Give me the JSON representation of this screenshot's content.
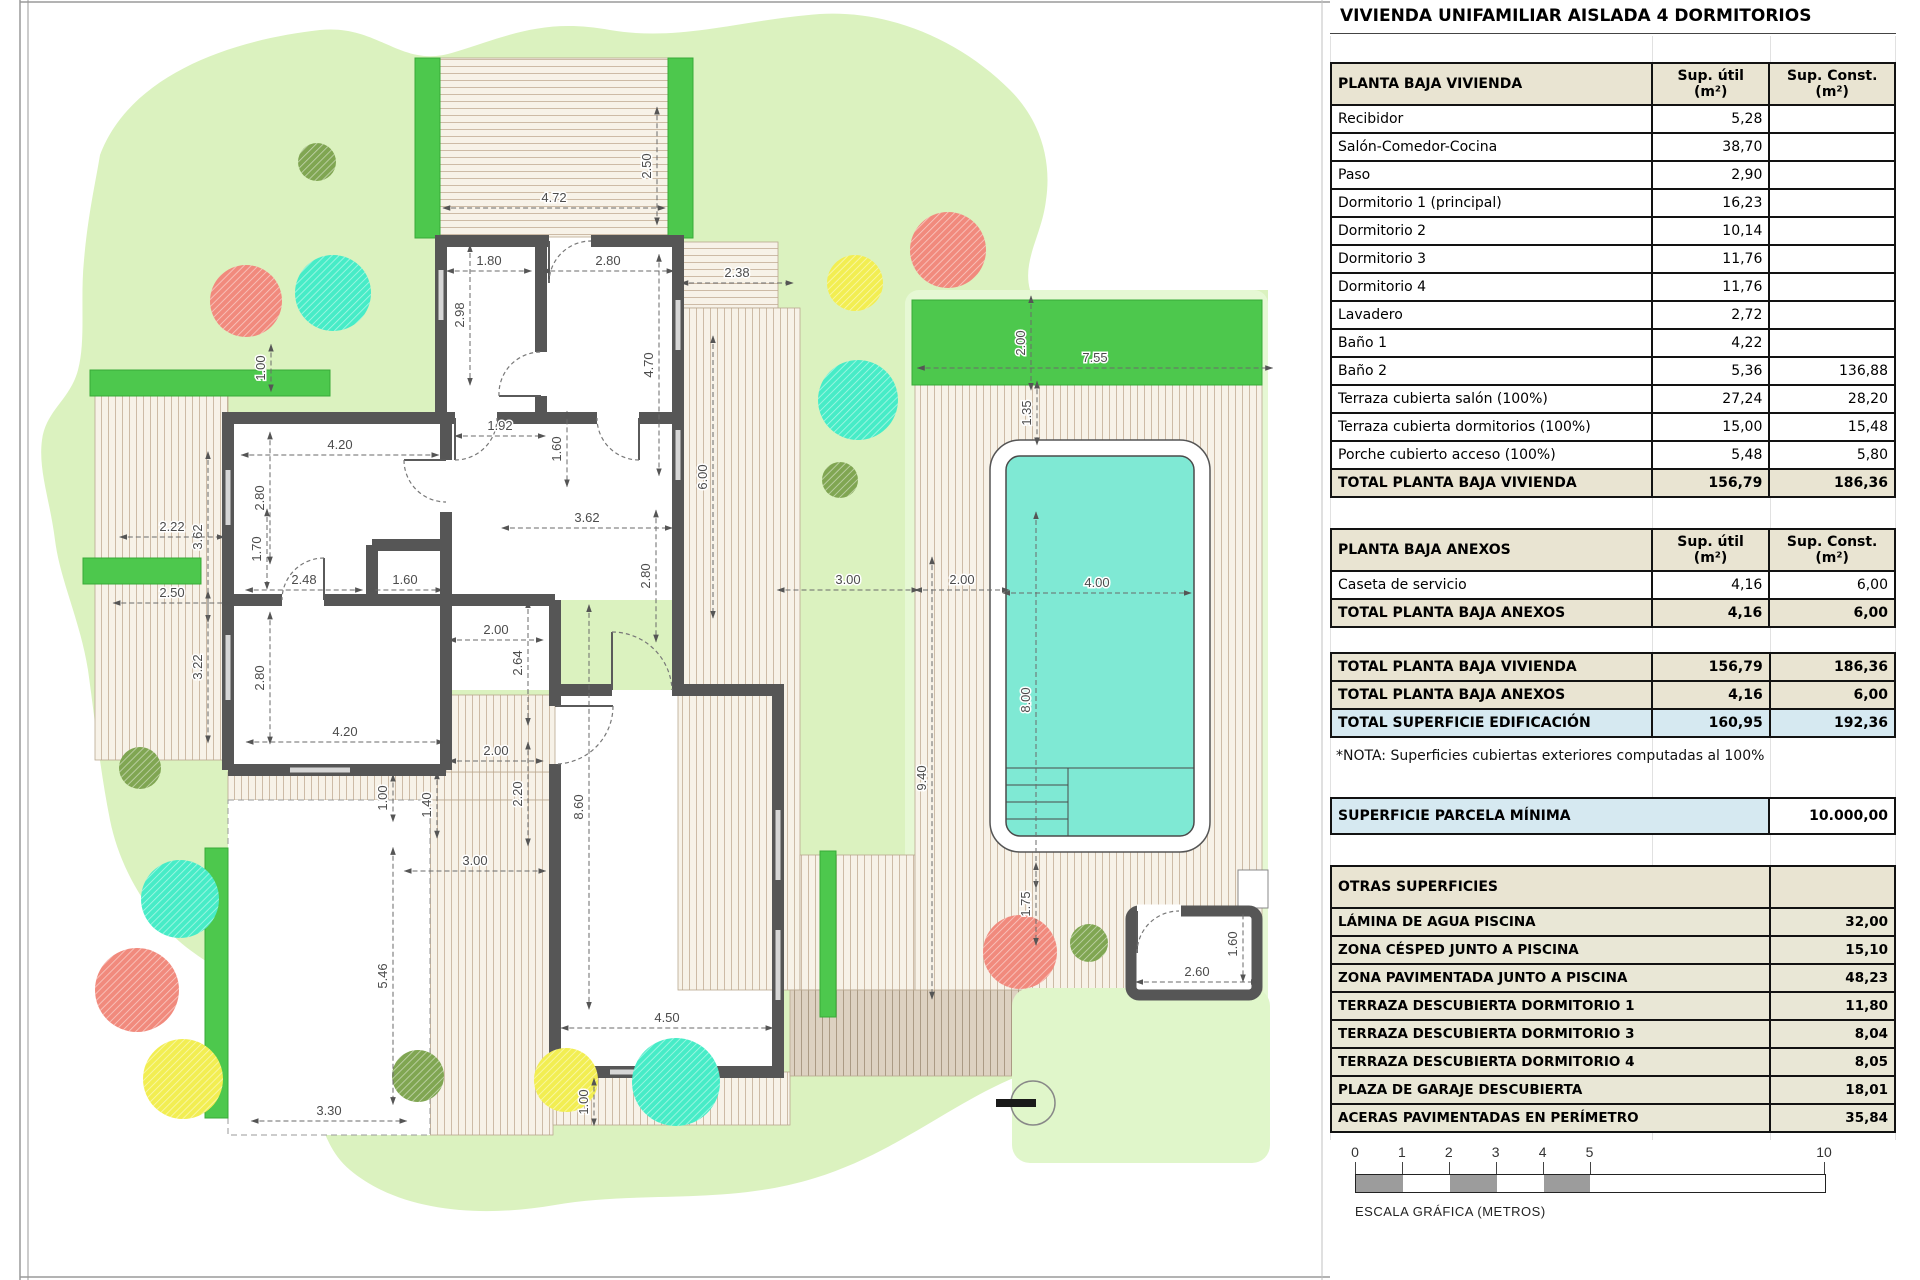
{
  "title": "VIVIENDA UNIFAMILIAR AISLADA 4 DORMITORIOS",
  "tables": {
    "vivienda": {
      "title": "PLANTA BAJA VIVIENDA",
      "col_util_l1": "Sup. útil",
      "col_const_l1": "Sup. Const.",
      "unit": "(m²)",
      "rows": [
        {
          "name": "Recibidor",
          "util": "5,28",
          "cons": ""
        },
        {
          "name": "Salón-Comedor-Cocina",
          "util": "38,70",
          "cons": ""
        },
        {
          "name": "Paso",
          "util": "2,90",
          "cons": ""
        },
        {
          "name": "Dormitorio 1 (principal)",
          "util": "16,23",
          "cons": ""
        },
        {
          "name": "Dormitorio 2",
          "util": "10,14",
          "cons": ""
        },
        {
          "name": "Dormitorio 3",
          "util": "11,76",
          "cons": ""
        },
        {
          "name": "Dormitorio 4",
          "util": "11,76",
          "cons": ""
        },
        {
          "name": "Lavadero",
          "util": "2,72",
          "cons": ""
        },
        {
          "name": "Baño 1",
          "util": "4,22",
          "cons": ""
        },
        {
          "name": "Baño 2",
          "util": "5,36",
          "cons": "136,88"
        },
        {
          "name": "Terraza cubierta salón (100%)",
          "util": "27,24",
          "cons": "28,20"
        },
        {
          "name": "Terraza cubierta dormitorios (100%)",
          "util": "15,00",
          "cons": "15,48"
        },
        {
          "name": "Porche cubierto acceso (100%)",
          "util": "5,48",
          "cons": "5,80"
        }
      ],
      "total": {
        "name": "TOTAL PLANTA BAJA VIVIENDA",
        "util": "156,79",
        "cons": "186,36"
      }
    },
    "anexos": {
      "title": "PLANTA BAJA ANEXOS",
      "rows": [
        {
          "name": "Caseta de servicio",
          "util": "4,16",
          "cons": "6,00"
        }
      ],
      "total": {
        "name": "TOTAL PLANTA BAJA ANEXOS",
        "util": "4,16",
        "cons": "6,00"
      }
    },
    "summary": {
      "rows": [
        {
          "name": "TOTAL PLANTA BAJA VIVIENDA",
          "util": "156,79",
          "cons": "186,36",
          "style": "beige"
        },
        {
          "name": "TOTAL PLANTA BAJA ANEXOS",
          "util": "4,16",
          "cons": "6,00",
          "style": "beige"
        },
        {
          "name": "TOTAL SUPERFICIE EDIFICACIÓN",
          "util": "160,95",
          "cons": "192,36",
          "style": "blue"
        }
      ]
    },
    "nota": "*NOTA: Superficies cubiertas exteriores computadas al 100%",
    "parcela": {
      "name": "SUPERFICIE PARCELA MÍNIMA",
      "value": "10.000,00"
    },
    "otras": {
      "title": "OTRAS SUPERFICIES",
      "rows": [
        {
          "name": "LÁMINA DE AGUA PISCINA",
          "value": "32,00"
        },
        {
          "name": "ZONA CÉSPED JUNTO A PISCINA",
          "value": "15,10"
        },
        {
          "name": "ZONA PAVIMENTADA JUNTO A PISCINA",
          "value": "48,23"
        },
        {
          "name": "TERRAZA DESCUBIERTA DORMITORIO 1",
          "value": "11,80"
        },
        {
          "name": "TERRAZA DESCUBIERTA DORMITORIO 3",
          "value": "8,04"
        },
        {
          "name": "TERRAZA DESCUBIERTA DORMITORIO 4",
          "value": "8,05"
        },
        {
          "name": "PLAZA DE GARAJE DESCUBIERTA",
          "value": "18,01"
        },
        {
          "name": "ACERAS PAVIMENTADAS EN PERÍMETRO",
          "value": "35,84"
        }
      ]
    }
  },
  "scale_bar": {
    "ticks": [
      0,
      1,
      2,
      3,
      4,
      5,
      10
    ],
    "px_per_m": 46.9,
    "label": "ESCALA GRÁFICA (METROS)"
  },
  "plan": {
    "colors": {
      "grass": "#dbf2bf",
      "grass_light": "#e6f8d4",
      "pool_water": "#7fe9d4",
      "hedge": "#4dc84d",
      "wall": "#565656",
      "tree_red": "#f18a7d",
      "tree_teal": "#47ecc7",
      "tree_yellow": "#f2ee52",
      "tree_olive": "#80a652",
      "row_beige": "#e9e4d2",
      "accent_blue": "#d6e9f1"
    },
    "px_per_m": 47,
    "dims": [
      {
        "v": "2.50",
        "x": 648,
        "y": 166,
        "o": "v"
      },
      {
        "v": "4.72",
        "x": 554,
        "y": 199,
        "o": "h"
      },
      {
        "v": "1.80",
        "x": 489,
        "y": 262,
        "o": "h"
      },
      {
        "v": "2.80",
        "x": 608,
        "y": 262,
        "o": "h"
      },
      {
        "v": "2.98",
        "x": 461,
        "y": 315,
        "o": "v"
      },
      {
        "v": "4.70",
        "x": 650,
        "y": 365,
        "o": "v"
      },
      {
        "v": "1.00",
        "x": 262,
        "y": 368,
        "o": "v"
      },
      {
        "v": "4.20",
        "x": 340,
        "y": 446,
        "o": "h"
      },
      {
        "v": "1.92",
        "x": 500,
        "y": 427,
        "o": "h"
      },
      {
        "v": "1.60",
        "x": 558,
        "y": 449,
        "o": "v"
      },
      {
        "v": "2.80",
        "x": 261,
        "y": 498,
        "o": "v"
      },
      {
        "v": "3.62",
        "x": 199,
        "y": 537,
        "o": "v"
      },
      {
        "v": "3.62",
        "x": 587,
        "y": 519,
        "o": "h"
      },
      {
        "v": "2.80",
        "x": 647,
        "y": 576,
        "o": "v"
      },
      {
        "v": "6.00",
        "x": 704,
        "y": 477,
        "o": "v"
      },
      {
        "v": "2.38",
        "x": 737,
        "y": 274,
        "o": "h"
      },
      {
        "v": "2.22",
        "x": 172,
        "y": 528,
        "o": "h"
      },
      {
        "v": "1.70",
        "x": 258,
        "y": 549,
        "o": "v"
      },
      {
        "v": "2.48",
        "x": 304,
        "y": 581,
        "o": "h"
      },
      {
        "v": "1.60",
        "x": 405,
        "y": 581,
        "o": "h"
      },
      {
        "v": "2.50",
        "x": 172,
        "y": 594,
        "o": "h"
      },
      {
        "v": "3.22",
        "x": 199,
        "y": 667,
        "o": "v"
      },
      {
        "v": "2.80",
        "x": 261,
        "y": 678,
        "o": "v"
      },
      {
        "v": "2.00",
        "x": 496,
        "y": 631,
        "o": "h"
      },
      {
        "v": "2.64",
        "x": 519,
        "y": 663,
        "o": "v"
      },
      {
        "v": "4.20",
        "x": 345,
        "y": 733,
        "o": "h"
      },
      {
        "v": "2.00",
        "x": 496,
        "y": 752,
        "o": "h"
      },
      {
        "v": "2.20",
        "x": 519,
        "y": 794,
        "o": "v"
      },
      {
        "v": "1.00",
        "x": 384,
        "y": 798,
        "o": "v"
      },
      {
        "v": "1.40",
        "x": 428,
        "y": 805,
        "o": "v"
      },
      {
        "v": "8.60",
        "x": 580,
        "y": 807,
        "o": "v"
      },
      {
        "v": "3.00",
        "x": 475,
        "y": 862,
        "o": "h"
      },
      {
        "v": "5.46",
        "x": 384,
        "y": 976,
        "o": "v"
      },
      {
        "v": "4.50",
        "x": 667,
        "y": 1019,
        "o": "h"
      },
      {
        "v": "3.30",
        "x": 329,
        "y": 1112,
        "o": "h"
      },
      {
        "v": "1.00",
        "x": 585,
        "y": 1102,
        "o": "v"
      },
      {
        "v": "9.40",
        "x": 923,
        "y": 778,
        "o": "v"
      },
      {
        "v": "3.00",
        "x": 848,
        "y": 581,
        "o": "h"
      },
      {
        "v": "2.00",
        "x": 962,
        "y": 581,
        "o": "h"
      },
      {
        "v": "7.55",
        "x": 1095,
        "y": 359,
        "o": "h"
      },
      {
        "v": "2.00",
        "x": 1022,
        "y": 343,
        "o": "v"
      },
      {
        "v": "1.35",
        "x": 1028,
        "y": 413,
        "o": "v"
      },
      {
        "v": "4.00",
        "x": 1097,
        "y": 584,
        "o": "h"
      },
      {
        "v": "8.00",
        "x": 1027,
        "y": 700,
        "o": "v"
      },
      {
        "v": "1.75",
        "x": 1027,
        "y": 904,
        "o": "v"
      },
      {
        "v": "2.60",
        "x": 1197,
        "y": 973,
        "o": "h"
      },
      {
        "v": "1.60",
        "x": 1234,
        "y": 944,
        "o": "v"
      }
    ],
    "trees": [
      {
        "x": 317,
        "y": 162,
        "r": 19,
        "c": "olive"
      },
      {
        "x": 246,
        "y": 301,
        "r": 36,
        "c": "red"
      },
      {
        "x": 333,
        "y": 293,
        "r": 38,
        "c": "teal"
      },
      {
        "x": 855,
        "y": 283,
        "r": 28,
        "c": "yellow"
      },
      {
        "x": 948,
        "y": 250,
        "r": 38,
        "c": "red"
      },
      {
        "x": 858,
        "y": 400,
        "r": 40,
        "c": "teal"
      },
      {
        "x": 840,
        "y": 480,
        "r": 18,
        "c": "olive"
      },
      {
        "x": 140,
        "y": 768,
        "r": 21,
        "c": "olive"
      },
      {
        "x": 180,
        "y": 899,
        "r": 39,
        "c": "teal"
      },
      {
        "x": 137,
        "y": 990,
        "r": 42,
        "c": "red"
      },
      {
        "x": 183,
        "y": 1079,
        "r": 40,
        "c": "yellow"
      },
      {
        "x": 418,
        "y": 1076,
        "r": 26,
        "c": "olive"
      },
      {
        "x": 566,
        "y": 1080,
        "r": 32,
        "c": "yellow"
      },
      {
        "x": 676,
        "y": 1082,
        "r": 44,
        "c": "teal"
      },
      {
        "x": 1020,
        "y": 952,
        "r": 37,
        "c": "red"
      },
      {
        "x": 1089,
        "y": 943,
        "r": 19,
        "c": "olive"
      }
    ]
  }
}
